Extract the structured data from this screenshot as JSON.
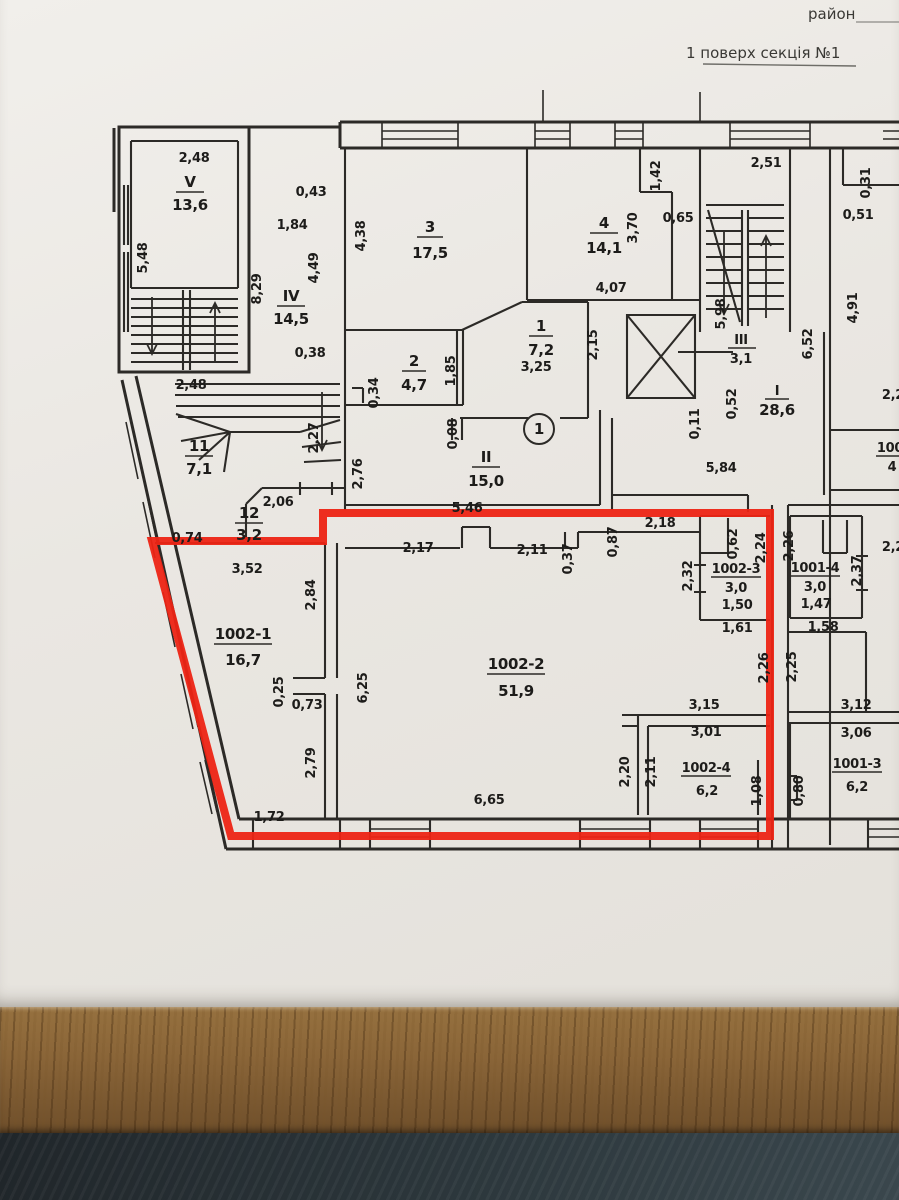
{
  "header": {
    "district_label": "район",
    "title": "1 поверх секція №1"
  },
  "accent": {
    "highlight_color": "#ed2414",
    "line_color": "#2c2a27",
    "paper_color": "#ece9e4"
  },
  "marks": {
    "entrance_number": "1"
  },
  "rooms": {
    "v": {
      "id": "V",
      "area": "13,6"
    },
    "iv": {
      "id": "IV",
      "area": "14,5"
    },
    "r11": {
      "id": "11",
      "area": "7,1"
    },
    "r12": {
      "id": "12",
      "area": "3,2"
    },
    "r3": {
      "id": "3",
      "area": "17,5"
    },
    "r2": {
      "id": "2",
      "area": "4,7"
    },
    "r1": {
      "id": "1",
      "area": "7,2"
    },
    "rII": {
      "id": "II",
      "area": "15,0"
    },
    "r4": {
      "id": "4",
      "area": "14,1"
    },
    "rIII": {
      "id": "III",
      "area": "3,1"
    },
    "rI": {
      "id": "I",
      "area": "28,6"
    },
    "u1002_1": {
      "id": "1002-1",
      "area": "16,7"
    },
    "u1002_2": {
      "id": "1002-2",
      "area": "51,9"
    },
    "u1002_3": {
      "id": "1002-3",
      "area": "3,0",
      "extra": "1,50"
    },
    "u1002_4": {
      "id": "1002-4",
      "area": "6,2"
    },
    "u1001_4": {
      "id": "1001-4",
      "area": "3,0",
      "extra": "1,47"
    },
    "u1001_3": {
      "id": "1001-3",
      "area": "6,2"
    },
    "edge": {
      "id": "100",
      "area": "4"
    }
  },
  "dims": [
    "2,48",
    "5,48",
    "0,43",
    "1,84",
    "8,29",
    "4,49",
    "0,38",
    "2,48",
    "2,27",
    "2,06",
    "0,74",
    "4,38",
    "0,34",
    "1,85",
    "3,25",
    "2,15",
    "0,08",
    "2,76",
    "5,46",
    "1,42",
    "3,70",
    "0,65",
    "4,07",
    "2,51",
    "5,98",
    "0,52",
    "0,11",
    "5,84",
    "0,31",
    "0,51",
    "4,91",
    "6,52",
    "2,2",
    "2,18",
    "0,87",
    "2,17",
    "2,11",
    "0,37",
    "3,52",
    "2,84",
    "6,25",
    "0,25",
    "0,73",
    "2,79",
    "1,72",
    "6,65",
    "2,32",
    "0,62",
    "2,24",
    "1,61",
    "2,26",
    "2,26",
    "2,37",
    "1,58",
    "2,25",
    "2,2",
    "3,15",
    "3,01",
    "2,20",
    "2,11",
    "1,08",
    "3,12",
    "3,06",
    "0,80"
  ]
}
